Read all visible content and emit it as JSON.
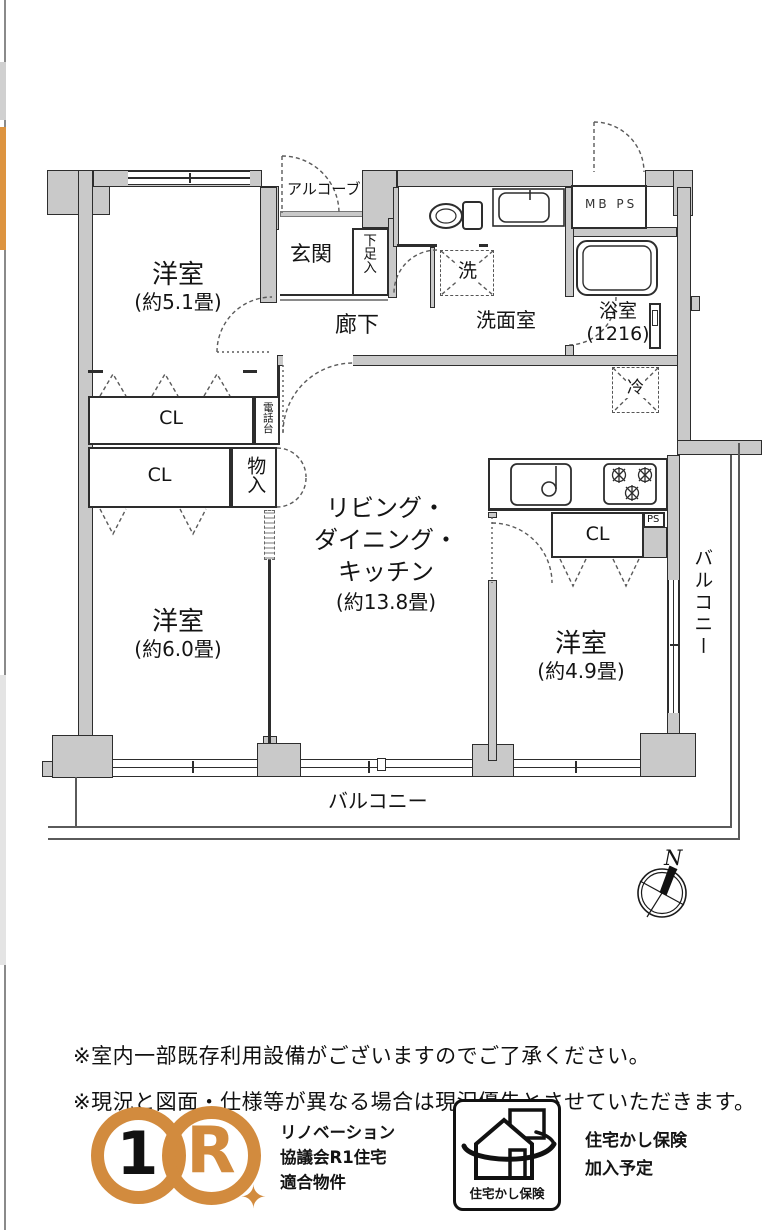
{
  "plan_labels": {
    "bedroom1_name": "洋室",
    "bedroom1_size": "(約5.1畳)",
    "bedroom2_name": "洋室",
    "bedroom2_size": "(約6.0畳)",
    "bedroom3_name": "洋室",
    "bedroom3_size": "(約4.9畳)",
    "ldk_line1": "リビング・",
    "ldk_line2": "ダイニング・",
    "ldk_line3": "キッチン",
    "ldk_size": "(約13.8畳)",
    "genkan": "玄関",
    "alcove": "アルコーブ",
    "shoe_box": "下足入",
    "hallway": "廊下",
    "washroom": "洗面室",
    "laundry": "洗",
    "bathroom": "浴室",
    "bathroom_size": "(1216)",
    "meter_pipe": "MB PS",
    "pipe_space": "PS",
    "fridge": "冷",
    "closet1": "CL",
    "closet2": "CL",
    "closet3": "CL",
    "phone_stand": "電話台",
    "storage": "物入",
    "balcony_bottom": "バルコニー",
    "balcony_right": "バルコニー",
    "compass_north": "N"
  },
  "notes": [
    "※室内一部既存利用設備がございますのでご了承ください。",
    "※現況と図面・仕様等が異なる場合は現況優先とさせていただきます。"
  ],
  "badges": {
    "r1_number": "1",
    "r1_letter": "R",
    "r1_star": "✦",
    "r1_lines": [
      "リノベーション",
      "協議会R1住宅",
      "適合物件"
    ],
    "warranty_badge_label": "住宅かし保険",
    "warranty_lines": [
      "住宅かし保険",
      "加入予定"
    ]
  },
  "colors": {
    "accent_orange": "#d28b3e",
    "wall_fill": "#c9c9c9",
    "line": "#2d2d2d"
  }
}
